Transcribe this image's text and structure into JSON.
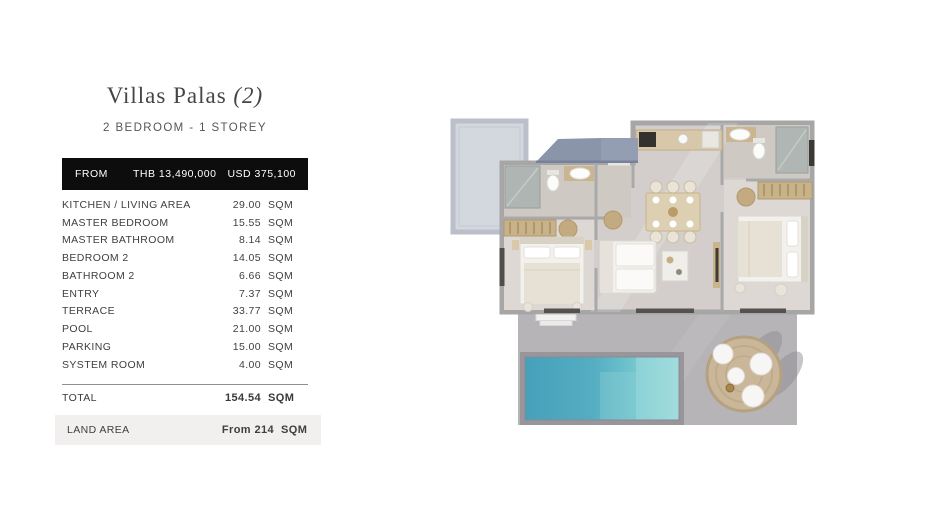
{
  "page": {
    "background": "#ffffff"
  },
  "header": {
    "title_main": "Villas Palas",
    "title_suffix": "(2)",
    "subtitle": "2 BEDROOM - 1 STOREY"
  },
  "price_bar": {
    "label": "FROM",
    "thb": "THB 13,490,000",
    "usd": "USD 375,100",
    "background": "#0d0d0d",
    "text_color": "#ffffff"
  },
  "area_table": {
    "unit": "SQM",
    "rows": [
      {
        "label": "KITCHEN / LIVING AREA",
        "value": "29.00"
      },
      {
        "label": "MASTER BEDROOM",
        "value": "15.55"
      },
      {
        "label": "MASTER BATHROOM",
        "value": "8.14"
      },
      {
        "label": "BEDROOM 2",
        "value": "14.05"
      },
      {
        "label": "BATHROOM 2",
        "value": "6.66"
      },
      {
        "label": "ENTRY",
        "value": "7.37"
      },
      {
        "label": "TERRACE",
        "value": "33.77"
      },
      {
        "label": "POOL",
        "value": "21.00"
      },
      {
        "label": "PARKING",
        "value": "15.00"
      },
      {
        "label": "SYSTEM ROOM",
        "value": "4.00"
      }
    ],
    "total": {
      "label": "TOTAL",
      "value": "154.54"
    },
    "land_area": {
      "label": "LAND AREA",
      "value": "From 214"
    }
  },
  "floor_plan": {
    "kind": "3d-top-down-villa-render",
    "features": [
      "parking-pad",
      "carport-roof",
      "master-bathroom",
      "master-wardrobe",
      "master-bedroom",
      "entry-hall",
      "kitchen",
      "dining-area",
      "living-area",
      "bathroom-2",
      "bedroom-2",
      "terrace",
      "pool",
      "outdoor-lounge-set",
      "plant"
    ],
    "colors": {
      "roof": "#8d98ac",
      "parking_pad": "#d3d7de",
      "wall": "#a6a6a6",
      "floor": "#d3cecb",
      "bedroom_floor": "#ddd8d4",
      "terrace": "#b7b4b8",
      "pool_water_dark": "#45a0ba",
      "pool_water_light": "#9cdadb",
      "wood": "#c8b28a",
      "white_furniture": "#f3f1ed",
      "plant": "#74925e"
    }
  }
}
